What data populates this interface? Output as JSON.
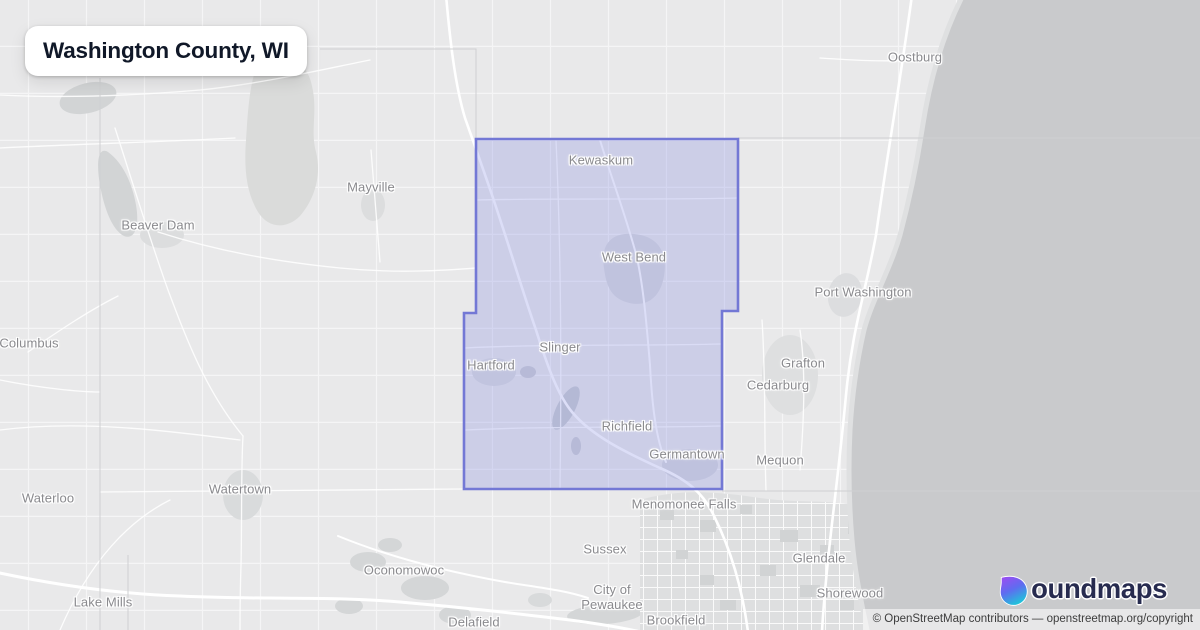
{
  "title_card": {
    "text": "Washington County, WI"
  },
  "map": {
    "county_name": "Washington County, WI",
    "boundary_points": "476,139 738,139 738,311 722,311 722,489 464,489 464,313 476,313",
    "colors": {
      "boundary_stroke": "#7378d5",
      "boundary_fill": "rgba(126,133,224,0.27)",
      "land": "#e9e9ea",
      "water": "#c9cacc",
      "road": "#ffffff",
      "label": "#8a8a8e",
      "logo_gradient_top": "#9c4df2",
      "logo_gradient_mid": "#5f6cf0",
      "logo_gradient_bottom": "#21c2da",
      "logo_text": "#272b4f",
      "title_text": "#101828"
    },
    "city_labels": [
      {
        "name": "Oostburg",
        "x": 915,
        "y": 58
      },
      {
        "name": "Kewaskum",
        "x": 601,
        "y": 161
      },
      {
        "name": "Mayville",
        "x": 371,
        "y": 188
      },
      {
        "name": "Beaver Dam",
        "x": 158,
        "y": 226
      },
      {
        "name": "West Bend",
        "x": 634,
        "y": 258
      },
      {
        "name": "Port Washington",
        "x": 863,
        "y": 293
      },
      {
        "name": "Columbus",
        "x": 29,
        "y": 344
      },
      {
        "name": "Slinger",
        "x": 560,
        "y": 348
      },
      {
        "name": "Grafton",
        "x": 803,
        "y": 364
      },
      {
        "name": "Hartford",
        "x": 491,
        "y": 366
      },
      {
        "name": "Cedarburg",
        "x": 778,
        "y": 386
      },
      {
        "name": "Richfield",
        "x": 627,
        "y": 427
      },
      {
        "name": "Germantown",
        "x": 687,
        "y": 455
      },
      {
        "name": "Mequon",
        "x": 780,
        "y": 461
      },
      {
        "name": "Watertown",
        "x": 240,
        "y": 490
      },
      {
        "name": "Waterloo",
        "x": 48,
        "y": 499
      },
      {
        "name": "Menomonee Falls",
        "x": 684,
        "y": 505
      },
      {
        "name": "Sussex",
        "x": 605,
        "y": 550
      },
      {
        "name": "Glendale",
        "x": 819,
        "y": 559
      },
      {
        "name": "Oconomowoc",
        "x": 404,
        "y": 571
      },
      {
        "name": "Shorewood",
        "x": 850,
        "y": 594
      },
      {
        "name": "City of\nPewaukee",
        "x": 612,
        "y": 598
      },
      {
        "name": "Lake Mills",
        "x": 103,
        "y": 603
      },
      {
        "name": "Brookfield",
        "x": 676,
        "y": 621
      },
      {
        "name": "Delafield",
        "x": 474,
        "y": 623
      }
    ]
  },
  "branding": {
    "wordmark": "boundmaps",
    "wordmark_rest": "oundmaps"
  },
  "attribution": {
    "text": "© OpenStreetMap contributors — openstreetmap.org/copyright"
  }
}
